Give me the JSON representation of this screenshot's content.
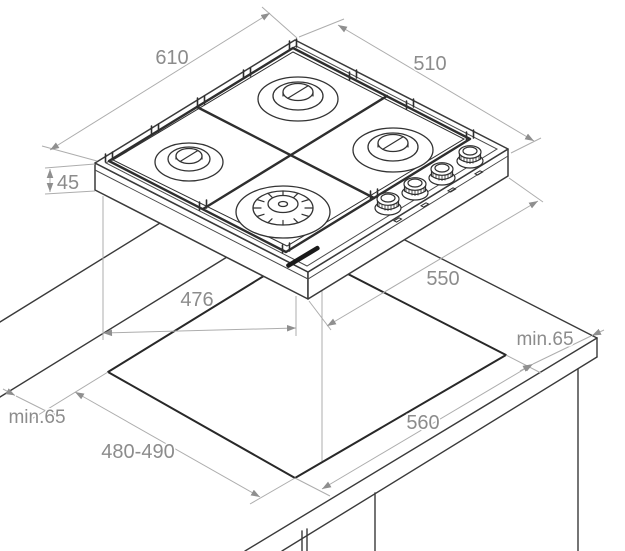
{
  "diagram": {
    "dimensions": {
      "hob_width": "610",
      "hob_depth": "510",
      "hob_height": "45",
      "hob_body_depth": "476",
      "hob_body_width": "550",
      "cutout_width": "560",
      "cutout_depth": "480-490",
      "clearance_back_left": "min.65",
      "clearance_right": "min.65"
    },
    "counts": {
      "burners": 4,
      "control_knobs": 4
    },
    "colors": {
      "background": "#ffffff",
      "outline": "#3a3a3a",
      "cutout_line": "#282828",
      "dimension_line": "#adadad",
      "dimension_text": "#8c8c8c",
      "grid_line": "#2e2e2e",
      "brand_mark": "#1a1a1a"
    }
  }
}
